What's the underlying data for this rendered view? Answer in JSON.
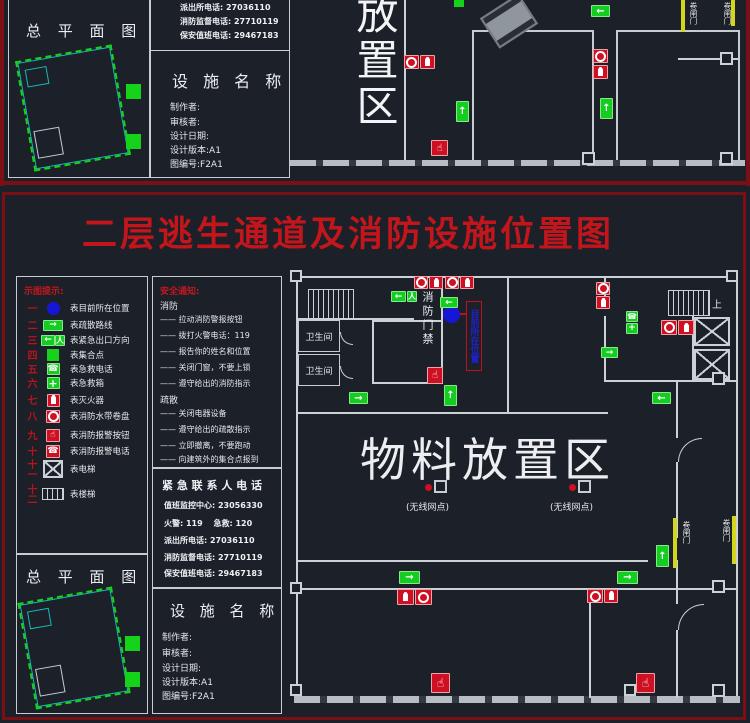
{
  "colors": {
    "accent_red": "#c3161c",
    "icon_red": "#ce1023",
    "green": "#14cd20",
    "blue": "#1617d6",
    "yellow": "#d4d61c",
    "wall": "#ccd1d7",
    "frame_red": "#7a1016"
  },
  "sheet1": {
    "site_plan_title": "总 平 面 图",
    "phones": [
      "派出所电话: 27036110",
      "消防监督电话: 27710119",
      "保安值班电话: 29467183"
    ],
    "facility_title": "设 施 名 称",
    "credits": [
      "制作者:",
      "审核者:",
      "设计日期:",
      "设计版本:A1",
      "图编号:F2A1"
    ],
    "zone_label": "放置区",
    "roller_door_1": "卷闸门",
    "roller_door_2": "卷闸门"
  },
  "sheet2": {
    "title": "二层逃生通道及消防设施位置图",
    "legend": {
      "header": "示图提示:",
      "items": [
        {
          "num": "一",
          "label": "表目前所在位置",
          "icon": "current-position-icon"
        },
        {
          "num": "二",
          "label": "表疏散路线",
          "icon": "escape-route-arrow-icon"
        },
        {
          "num": "三",
          "label": "表紧急出口方向",
          "icon": "emergency-exit-direction-icon"
        },
        {
          "num": "四",
          "label": "表集合点",
          "icon": "assembly-point-icon"
        },
        {
          "num": "五",
          "label": "表急救电话",
          "icon": "first-aid-phone-icon"
        },
        {
          "num": "六",
          "label": "表急救箱",
          "icon": "first-aid-box-icon"
        },
        {
          "num": "七",
          "label": "表灭火器",
          "icon": "fire-extinguisher-icon"
        },
        {
          "num": "八",
          "label": "表消防水带卷盘",
          "icon": "fire-hose-reel-icon"
        },
        {
          "num": "九",
          "label": "表消防报警按钮",
          "icon": "fire-alarm-button-icon"
        },
        {
          "num": "十",
          "label": "表消防报警电话",
          "icon": "fire-alarm-phone-icon"
        },
        {
          "num": "十一",
          "label": "表电梯",
          "icon": "elevator-icon"
        },
        {
          "num": "十二",
          "label": "表楼梯",
          "icon": "stairs-icon"
        }
      ]
    },
    "safety": {
      "header": "安全通知:",
      "fire_header": "消防",
      "fire_items": [
        "—— 拉动消防警报按钮",
        "—— 拨打火警电话：119",
        "—— 报告你的姓名和位置",
        "—— 关闭门窗，不要上锁",
        "—— 遵守给出的消防指示"
      ],
      "evac_header": "疏散",
      "evac_items": [
        "—— 关闭电器设备",
        "—— 遵守给出的疏散指示",
        "—— 立即撤离，不要跑动",
        "—— 向建筑外的集合点报到"
      ]
    },
    "contacts": {
      "header": "紧 急 联 系 人 电 话",
      "lines": [
        "值班监控中心: 23056330",
        "火警: 119　 急救: 120",
        "派出所电话: 27036110",
        "消防监督电话: 27710119",
        "保安值班电话: 29467183"
      ]
    },
    "site_plan_title": "总 平 面 图",
    "facility_title": "设 施 名 称",
    "credits": [
      "制作者:",
      "审核者:",
      "设计日期:",
      "设计版本:A1",
      "图编号:F2A1"
    ],
    "plan": {
      "restroom_1": "卫生间",
      "restroom_2": "卫生间",
      "fire_door_label": "消防门禁",
      "stairs_up_label": "上",
      "zone_label": "物料放置区",
      "wifi_label_1": "(无线网点)",
      "wifi_label_2": "(无线网点)",
      "current_position_label": "目前所在位置",
      "roller_door_1": "卷闸门",
      "roller_door_2": "卷闸门"
    }
  }
}
